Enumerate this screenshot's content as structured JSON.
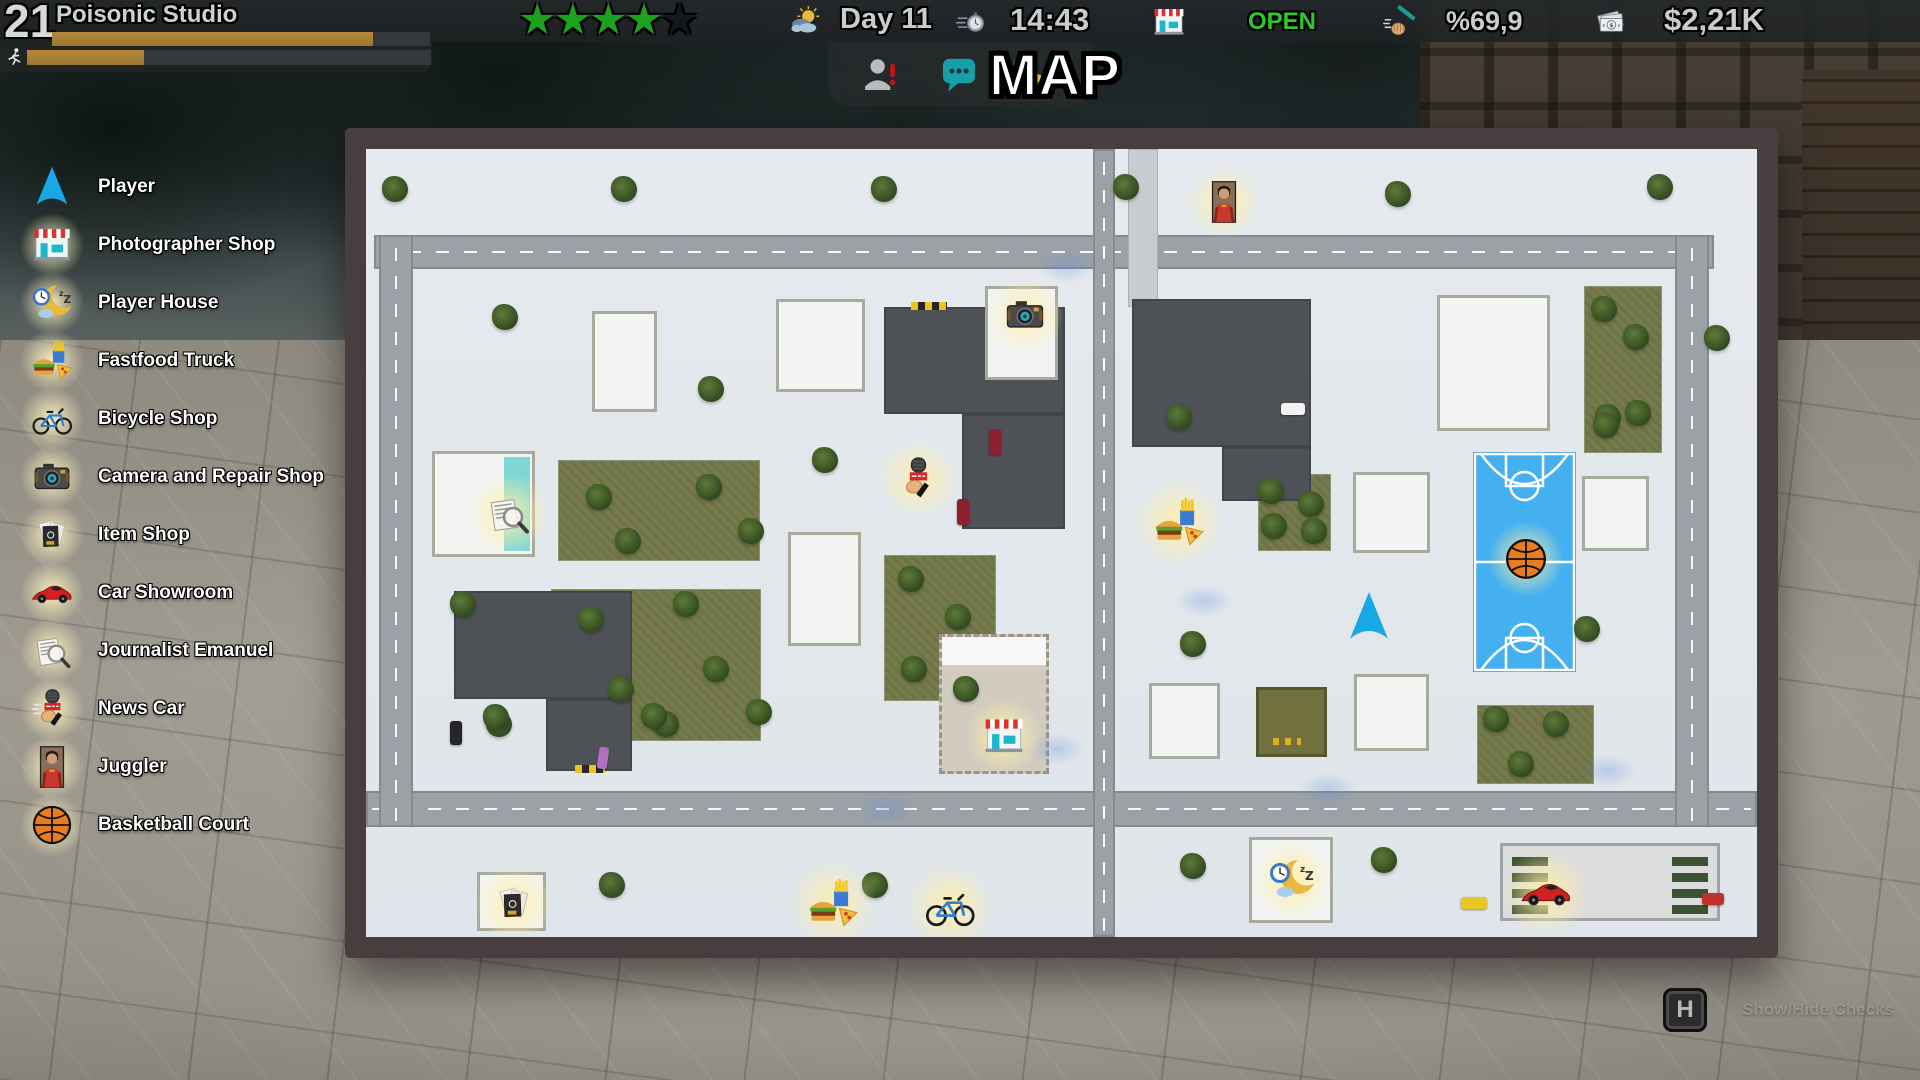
{
  "hud": {
    "level": "21",
    "studio_name": "Poisonic Studio",
    "level_progress_pct": 85,
    "stamina_progress_pct": 29,
    "rating_stars_filled": 4,
    "rating_stars_total": 5,
    "day_label": "Day 11",
    "time": "14:43",
    "shop_status": "OPEN",
    "cleanliness": "%69,9",
    "money": "$2,21K",
    "accent_colors": {
      "open_green": "#2ec82e",
      "star_green": "#1da21d",
      "xp_gold": "#b3893a",
      "player_cyan": "#19a8e6"
    }
  },
  "map_screen": {
    "title": "MAP",
    "hint_key": "H",
    "hint_label": "Show/Hide Checks"
  },
  "legend": {
    "items": [
      {
        "label": "Player",
        "icon": "player"
      },
      {
        "label": "Photographer Shop",
        "icon": "shop"
      },
      {
        "label": "Player House",
        "icon": "sleep"
      },
      {
        "label": "Fastfood Truck",
        "icon": "fastfood"
      },
      {
        "label": "Bicycle Shop",
        "icon": "bicycle"
      },
      {
        "label": "Camera and Repair Shop",
        "icon": "camera"
      },
      {
        "label": "Item Shop",
        "icon": "items"
      },
      {
        "label": "Car Showroom",
        "icon": "car"
      },
      {
        "label": "Journalist Emanuel",
        "icon": "journalist"
      },
      {
        "label": "News Car",
        "icon": "mic"
      },
      {
        "label": "Juggler",
        "icon": "juggler"
      },
      {
        "label": "Basketball Court",
        "icon": "basketball"
      }
    ]
  },
  "map": {
    "roads": [
      [
        8,
        86,
        1340,
        34,
        "h"
      ],
      [
        0,
        642,
        1391,
        36,
        "h"
      ],
      [
        13,
        86,
        34,
        592,
        "v"
      ],
      [
        1309,
        86,
        34,
        592,
        "v"
      ],
      [
        727,
        0,
        22,
        788,
        "v"
      ]
    ],
    "walkways": [
      [
        762,
        0,
        30,
        158
      ]
    ],
    "green_patches": [
      [
        192,
        311,
        200,
        99
      ],
      [
        185,
        440,
        208,
        150
      ],
      [
        518,
        406,
        110,
        144
      ],
      [
        892,
        325,
        71,
        75
      ],
      [
        1111,
        556,
        115,
        77
      ],
      [
        1218,
        137,
        76,
        165
      ]
    ],
    "dark_lots": [
      [
        88,
        442,
        178,
        108
      ],
      [
        180,
        550,
        86,
        72
      ],
      [
        518,
        158,
        181,
        107
      ],
      [
        596,
        265,
        103,
        115
      ],
      [
        766,
        150,
        179,
        148
      ],
      [
        856,
        298,
        89,
        54
      ]
    ],
    "buildings": [
      [
        226,
        162,
        65,
        101,
        "w"
      ],
      [
        410,
        150,
        89,
        93,
        "w"
      ],
      [
        422,
        383,
        73,
        114,
        "w"
      ],
      [
        619,
        137,
        73,
        94,
        "w"
      ],
      [
        66,
        302,
        103,
        106,
        "pool"
      ],
      [
        573,
        485,
        110,
        140,
        "beige"
      ],
      [
        987,
        323,
        77,
        81,
        "w"
      ],
      [
        1216,
        327,
        67,
        75,
        "w"
      ],
      [
        783,
        534,
        71,
        76,
        "w"
      ],
      [
        988,
        525,
        75,
        77,
        "w"
      ],
      [
        1071,
        146,
        113,
        136,
        "w"
      ],
      [
        111,
        723,
        69,
        59,
        "w"
      ],
      [
        883,
        688,
        84,
        86,
        "w"
      ],
      [
        1134,
        694,
        220,
        78,
        "showroom"
      ],
      [
        890,
        538,
        71,
        70,
        "olive"
      ]
    ],
    "court": [
      1107,
      303,
      103,
      220
    ],
    "hatches": [
      [
        545,
        153,
        36
      ],
      [
        209,
        616,
        30
      ]
    ],
    "splotches": [
      [
        690,
        600
      ],
      [
        838,
        452
      ],
      [
        962,
        640
      ],
      [
        700,
        118
      ],
      [
        1242,
        622
      ],
      [
        520,
        660
      ]
    ],
    "trees": [
      [
        29,
        40
      ],
      [
        258,
        40
      ],
      [
        518,
        40
      ],
      [
        760,
        38
      ],
      [
        1032,
        45
      ],
      [
        1294,
        38
      ],
      [
        139,
        168
      ],
      [
        345,
        240
      ],
      [
        459,
        311
      ],
      [
        97,
        455
      ],
      [
        133,
        575
      ],
      [
        233,
        348
      ],
      [
        343,
        338
      ],
      [
        262,
        392
      ],
      [
        385,
        382
      ],
      [
        225,
        470
      ],
      [
        320,
        455
      ],
      [
        255,
        540
      ],
      [
        350,
        520
      ],
      [
        300,
        575
      ],
      [
        545,
        430
      ],
      [
        592,
        468
      ],
      [
        548,
        520
      ],
      [
        600,
        540
      ],
      [
        813,
        268
      ],
      [
        1242,
        268
      ],
      [
        827,
        495
      ],
      [
        1221,
        480
      ],
      [
        905,
        342
      ],
      [
        945,
        355
      ],
      [
        908,
        377
      ],
      [
        948,
        382
      ],
      [
        1130,
        570
      ],
      [
        1190,
        575
      ],
      [
        1155,
        615
      ],
      [
        1238,
        160
      ],
      [
        1270,
        188
      ],
      [
        1240,
        276
      ],
      [
        1272,
        264
      ],
      [
        1351,
        189
      ],
      [
        827,
        717
      ],
      [
        1018,
        711
      ],
      [
        130,
        568
      ],
      [
        288,
        567
      ],
      [
        393,
        563
      ],
      [
        246,
        736
      ],
      [
        509,
        736
      ]
    ],
    "cars": [
      [
        915,
        254,
        24,
        12,
        "#f2f2f2",
        0
      ],
      [
        623,
        280,
        12,
        26,
        "#8e1f2f",
        0
      ],
      [
        591,
        350,
        12,
        26,
        "#8e1f2f",
        0
      ],
      [
        232,
        598,
        10,
        22,
        "#b06fc0",
        8
      ],
      [
        1095,
        748,
        26,
        12,
        "#e8c820",
        0
      ],
      [
        1336,
        744,
        22,
        12,
        "#c03028",
        0
      ],
      [
        84,
        572,
        12,
        24,
        "#26262a",
        0
      ]
    ],
    "markers": [
      {
        "icon": "juggler",
        "x": 858,
        "y": 53,
        "s": 44,
        "glow": true
      },
      {
        "icon": "camera",
        "x": 659,
        "y": 166,
        "s": 46,
        "glow": true
      },
      {
        "icon": "mic",
        "x": 552,
        "y": 330,
        "s": 48,
        "glow": true
      },
      {
        "icon": "journalist",
        "x": 142,
        "y": 365,
        "s": 50,
        "glow": true
      },
      {
        "icon": "fastfood",
        "x": 813,
        "y": 374,
        "s": 54,
        "glow": true
      },
      {
        "icon": "basketball",
        "x": 1160,
        "y": 410,
        "s": 46,
        "glow": true
      },
      {
        "icon": "player",
        "x": 1003,
        "y": 468,
        "s": 54,
        "glow": false
      },
      {
        "icon": "shop",
        "x": 638,
        "y": 587,
        "s": 46,
        "glow": true
      },
      {
        "icon": "items",
        "x": 148,
        "y": 755,
        "s": 48,
        "glow": true
      },
      {
        "icon": "fastfood",
        "x": 467,
        "y": 755,
        "s": 54,
        "glow": true
      },
      {
        "icon": "bicycle",
        "x": 584,
        "y": 758,
        "s": 54,
        "glow": true
      },
      {
        "icon": "sleep",
        "x": 926,
        "y": 731,
        "s": 50,
        "glow": true
      },
      {
        "icon": "car",
        "x": 1180,
        "y": 744,
        "s": 54,
        "glow": true
      }
    ]
  }
}
